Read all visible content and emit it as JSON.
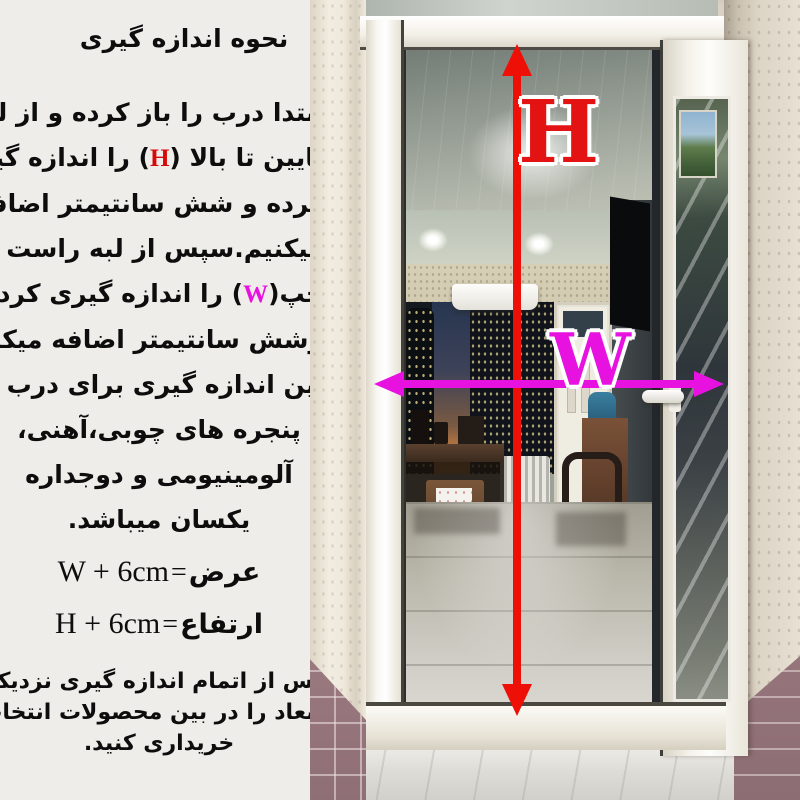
{
  "instructions": {
    "title": "نحوه اندازه گیری",
    "lines": [
      {
        "text": "ابتدا درب را باز کرده و از لبه"
      },
      {
        "pre": "پایین تا بالا (",
        "mark": "H",
        "post": ") را اندازه گیری"
      },
      {
        "text": "کرده و شش سانتیمتر اضافه"
      },
      {
        "text": "میکنیم.سپس از لبه راست تا"
      },
      {
        "pre": "چپ(",
        "mark": "W",
        "post": ") را اندازه گیری کرده"
      },
      {
        "text": "وشش سانتیمتر اضافه میکنیم."
      },
      {
        "text": "این اندازه گیری برای درب و"
      },
      {
        "text": "پنجره های چوبی،آهنی،"
      },
      {
        "text": "آلومینیومی و دوجداره"
      },
      {
        "text": "یکسان میباشد."
      }
    ],
    "formulas": [
      {
        "label": "عرض",
        "eq": "=",
        "value": "W + 6cm"
      },
      {
        "label": "ارتفاع",
        "eq": "=",
        "value": "H + 6cm"
      }
    ],
    "footer_lines": [
      "پس از اتمام اندازه گیری نزدیکترین",
      "ابعاد را در بین محصولات انتخاب و",
      "خریداری کنید."
    ]
  },
  "annotations": {
    "height_letter": "H",
    "width_letter": "W",
    "height_color": "#e31313",
    "width_color": "#e812e0"
  }
}
